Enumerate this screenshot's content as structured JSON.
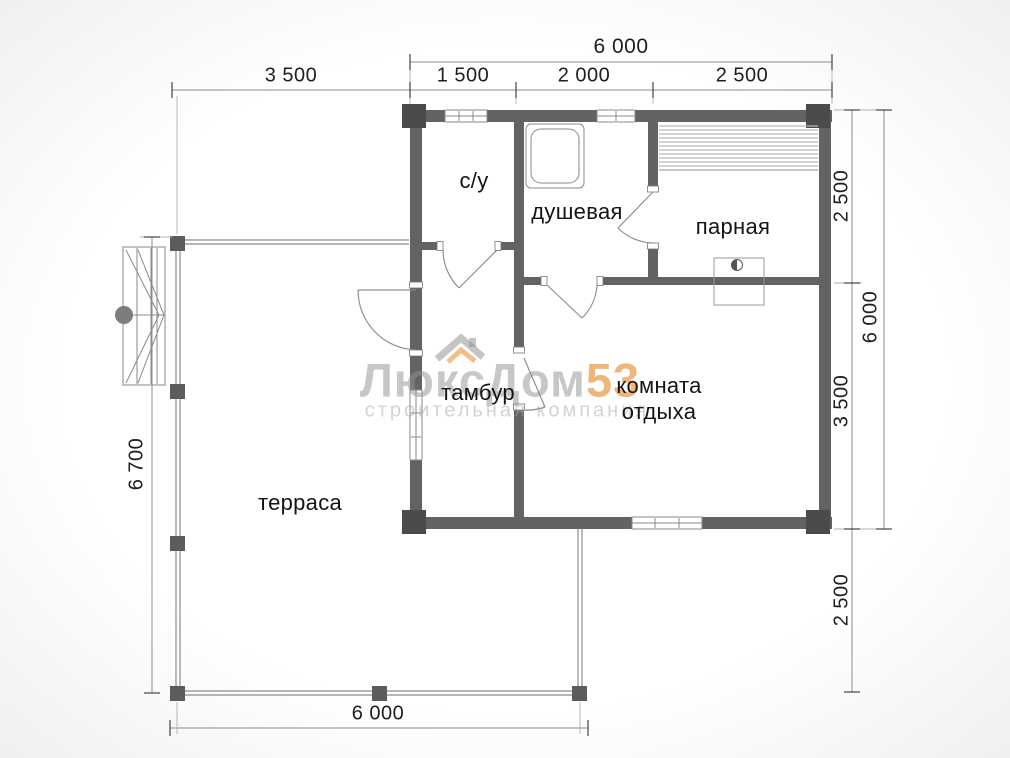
{
  "plan_title": "bath-house floor plan",
  "rooms": {
    "wc": {
      "label": "с/у"
    },
    "shower": {
      "label": "душевая"
    },
    "steam": {
      "label": "парная"
    },
    "vestibule": {
      "label": "тамбур"
    },
    "lounge_line1": "комната",
    "lounge_line2": "отдыха",
    "terrace": {
      "label": "терраса"
    }
  },
  "dims": {
    "top_total": "6 000",
    "top_segments": [
      "3 500",
      "1 500",
      "2 000",
      "2 500"
    ],
    "right_upper": "2 500",
    "right_mid": "3 500",
    "right_lower": "2 500",
    "right_total": "6 000",
    "left_total": "6 700",
    "bottom_total": "6 000"
  },
  "watermark": {
    "brand_gray": "ЛюксДом",
    "brand_accent": "53",
    "subtitle": "строительная компания"
  },
  "colors": {
    "wall_gray": "#636363",
    "corner_gray": "#4b4b4b",
    "thin_line_gray": "#8f8f8f",
    "accent_orange": "#e8953c"
  }
}
